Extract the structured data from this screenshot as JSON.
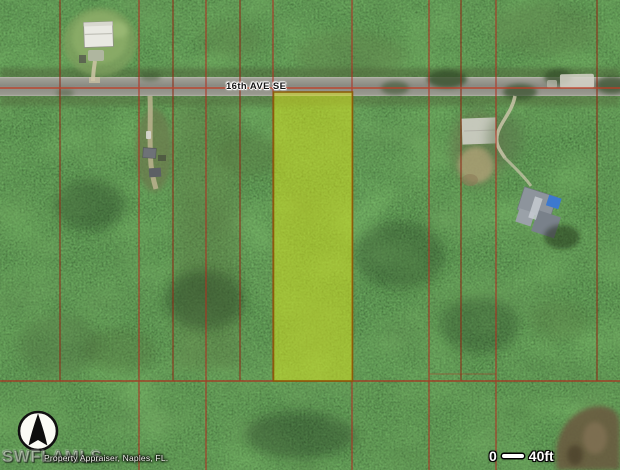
{
  "map": {
    "street_label": "16th AVE SE",
    "watermark": "SWFLAMLS",
    "attribution": "Property Appraiser, Naples, FL.",
    "scale_bar": {
      "zero_label": "0",
      "distance_label": "40ft"
    },
    "icons": {
      "compass": "north-arrow-icon"
    },
    "colors": {
      "parcel_line": "#b03022",
      "highlight_fill": "#d6e01c",
      "highlight_border": "#8a5c07",
      "road": "#8e8e86",
      "forest_base": "#2a411f",
      "scale_bar_text": "#ffffff"
    }
  }
}
